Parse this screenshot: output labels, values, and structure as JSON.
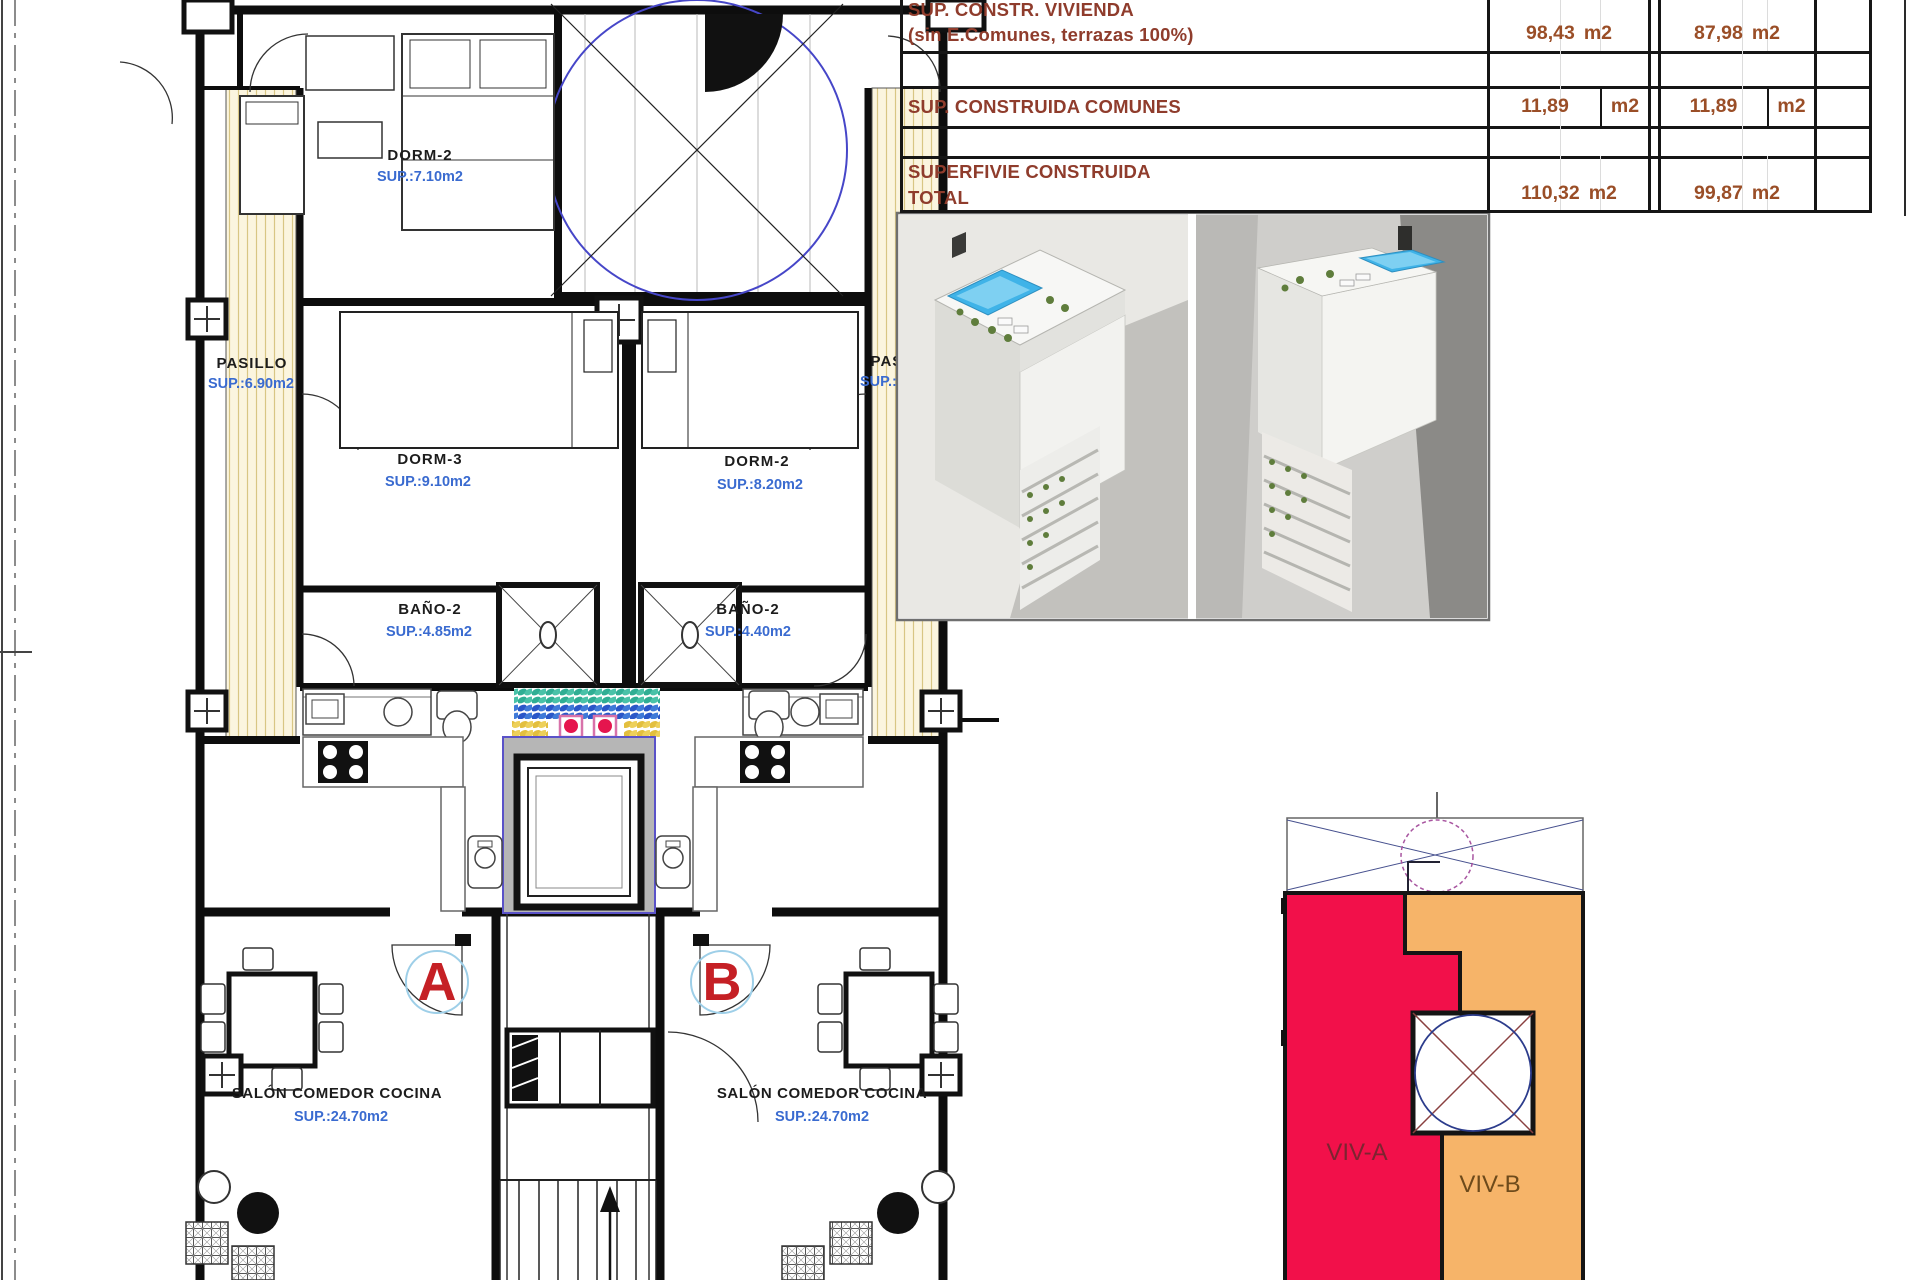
{
  "summary_table": {
    "rows": [
      {
        "label": "SUP. CONSTR. VIVIENDA",
        "sublabel": "(sin E.Comunes, terrazas 100%)",
        "a_value": "98,43",
        "a_unit": "m2",
        "b_value": "87,98",
        "b_unit": "m2"
      },
      {
        "label": "SUP. CONSTRUIDA COMUNES",
        "sublabel": "",
        "a_value": "11,89",
        "a_unit": "m2",
        "b_value": "11,89",
        "b_unit": "m2"
      },
      {
        "label": "SUPERFIVIE CONSTRUIDA",
        "sublabel": "TOTAL",
        "a_value": "110,32",
        "a_unit": "m2",
        "b_value": "99,87",
        "b_unit": "m2"
      }
    ]
  },
  "floor_plan": {
    "rooms": [
      {
        "name": "DORM-2",
        "area": "SUP.:7.10m2"
      },
      {
        "name": "PASILLO",
        "area": "SUP.:6.90m2"
      },
      {
        "name": "PASILLO",
        "area": "SUP.:7.50m2"
      },
      {
        "name": "DORM-3",
        "area": "SUP.:9.10m2"
      },
      {
        "name": "DORM-2",
        "area": "SUP.:8.20m2"
      },
      {
        "name": "BAÑO-2",
        "area": "SUP.:4.85m2"
      },
      {
        "name": "BAÑO-2",
        "area": "SUP.:4.40m2"
      },
      {
        "name": "SALÓN COMEDOR COCINA",
        "area": "SUP.:24.70m2"
      },
      {
        "name": "SALÓN COMEDOR COCINA",
        "area": "SUP.:24.70m2"
      }
    ],
    "unit_a_marker": "A",
    "unit_b_marker": "B"
  },
  "site_plan": {
    "unit_a_label": "VIV-A",
    "unit_b_label": "VIV-B"
  },
  "colors": {
    "viv_a": "#f2104a",
    "viv_b": "#f6b469",
    "viv_a_text": "#7c2430",
    "viv_b_text": "#6d4a1b",
    "pool": "#3fb3e8",
    "area_text": "#3a6bd0",
    "marker": "#c52025",
    "table_label": "#8f3c2c",
    "table_value": "#9a4e27",
    "hatch_line": "#d8c684"
  }
}
